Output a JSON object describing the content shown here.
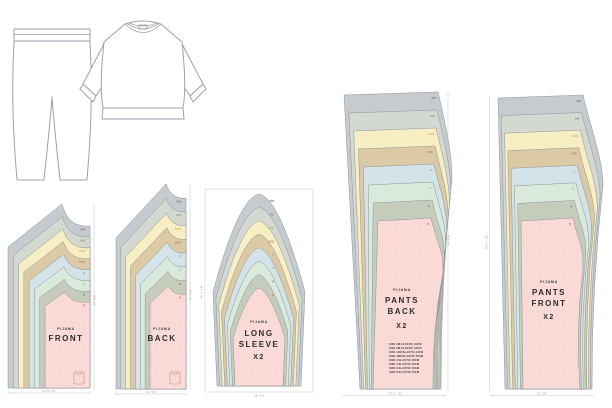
{
  "sizes": [
    "3M",
    "6M",
    "12M",
    "18M",
    "2",
    "4",
    "6",
    "8"
  ],
  "palette": {
    "layers": [
      "#c6cbd0",
      "#d3d9d1",
      "#f7eec3",
      "#dcc9a5",
      "#d3e3e7",
      "#d9eadd",
      "#c6ccbb",
      "#fadbd8"
    ],
    "label_colors": [
      "#70767c",
      "#839082",
      "#c9b469",
      "#b78c50",
      "#7e9aa4",
      "#84a28b",
      "#6d7365",
      "#d06a60"
    ],
    "outline": "#8d9399",
    "pink": "#fadbd8",
    "text": "#2d2d2d"
  },
  "pieces": {
    "front": {
      "brand": "PIJAMA",
      "name": "FRONT",
      "width_label": "44.5 CM",
      "height_label": "54 CM"
    },
    "back": {
      "brand": "PIJAMA",
      "name": "BACK",
      "width_label": "40 CM",
      "height_label": "57 CM"
    },
    "sleeve": {
      "brand": "PIJAMA",
      "name_line1": "LONG",
      "name_line2": "SLEEVE",
      "qty": "X2",
      "width_label": "36 CM",
      "height_label": "60.5 CM"
    },
    "pants_back": {
      "brand": "PIJAMA",
      "name_line1": "PANTS",
      "name_line2": "BACK",
      "qty": "X2",
      "width_label": "33.5 CM",
      "height_label": "89 CM",
      "elastic_notes": [
        "SIZE 3M ELASTIC 40CM",
        "SIZE 6M ELASTIC 42CM",
        "SIZE 12M ELASTIC 44CM",
        "SIZE 18M ELASTIC 46CM",
        "SIZE 2 ELASTIC 48CM",
        "SIZE 4 ELASTIC 50CM",
        "SIZE 6 ELASTIC 52CM",
        "SIZE 8 ELASTIC 54CM"
      ]
    },
    "pants_front": {
      "brand": "PIJAMA",
      "name_line1": "PANTS",
      "name_line2": "FRONT",
      "qty": "X2",
      "width_label": "30 CM",
      "height_label": "88.5 CM"
    }
  }
}
